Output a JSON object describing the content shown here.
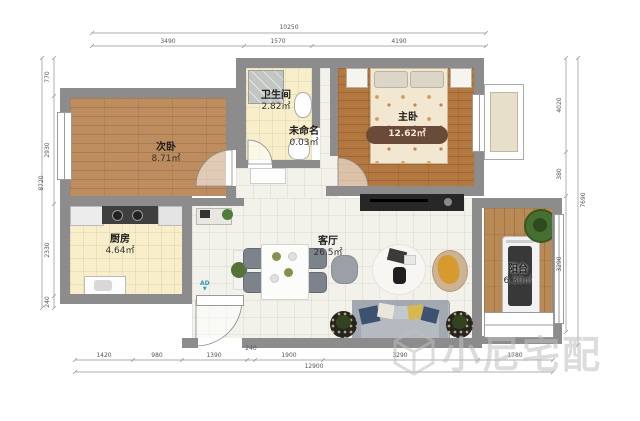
{
  "plan": {
    "rooms": [
      {
        "id": "secondary-bedroom",
        "name": "次卧",
        "area": "8.71㎡"
      },
      {
        "id": "bathroom",
        "name": "卫生间",
        "area": "2.82㎡"
      },
      {
        "id": "unnamed",
        "name": "未命名",
        "area": "0.03㎡"
      },
      {
        "id": "master-bedroom",
        "name": "主卧",
        "area": "12.62㎡"
      },
      {
        "id": "kitchen",
        "name": "厨房",
        "area": "4.64㎡"
      },
      {
        "id": "living-room",
        "name": "客厅",
        "area": "26.5㎡"
      },
      {
        "id": "balcony",
        "name": "阳台",
        "area": "6.30㎡"
      }
    ],
    "entry_marker": "AD"
  },
  "dimensions": {
    "top": {
      "total": "10250",
      "segments": [
        "3490",
        "1570",
        "4190"
      ]
    },
    "bottom": {
      "total": "12900",
      "segments": [
        "1420",
        "980",
        "1390",
        "240",
        "1900",
        "3290",
        "1780"
      ]
    },
    "left": {
      "total": "8720",
      "segments": [
        "770",
        "2930",
        "2330",
        "240"
      ]
    },
    "right": {
      "total": "7690",
      "segments": [
        "4020",
        "380",
        "3290"
      ]
    }
  },
  "watermark": {
    "text": "小尼宅配"
  },
  "colors": {
    "wall": "#8c8c8c",
    "wood_floor": "#bd8d5f",
    "master_wood": "#b2783f",
    "tile_cream": "#f8efca",
    "tile_white": "#f2f1ea",
    "entry_marker_blue": "#2e9bbf",
    "watermark_gray": "#c0c0c0"
  }
}
